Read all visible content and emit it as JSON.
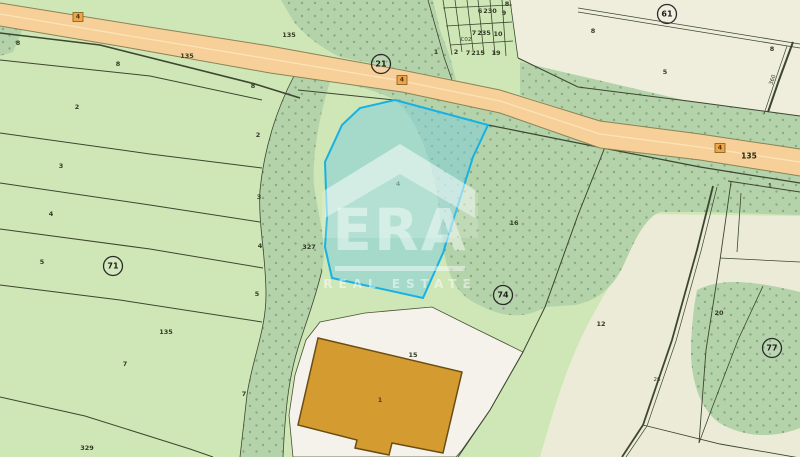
{
  "watermark": {
    "brand": "ERA",
    "subtitle": "REAL ESTATE"
  },
  "colors": {
    "background_green": "#cfe7b6",
    "vegetation_green": "#b4d3aa",
    "vegetation_dot": "#87ab80",
    "cream_parcel": "#efeedd",
    "courtyard_white": "#f4f2ea",
    "road_fill": "#f6cf99",
    "selected_parcel_stroke": "#17b1e3",
    "selected_parcel_fill": "rgba(124,205,222,0.5)",
    "building_fill": "#d49b31",
    "boundary_line": "#3c4630"
  },
  "map": {
    "selected_parcel_label": "4",
    "road_markers": [
      {
        "text": "4",
        "x": 78,
        "y": 17
      },
      {
        "text": "4",
        "x": 402,
        "y": 80
      },
      {
        "text": "4",
        "x": 720,
        "y": 148
      }
    ],
    "circled_labels": [
      {
        "text": "21",
        "x": 381,
        "y": 64
      },
      {
        "text": "61",
        "x": 667,
        "y": 14
      },
      {
        "text": "71",
        "x": 113,
        "y": 266
      },
      {
        "text": "74",
        "x": 503,
        "y": 295
      },
      {
        "text": "77",
        "x": 772,
        "y": 348
      }
    ],
    "labels": [
      {
        "text": "8",
        "x": 18,
        "y": 43
      },
      {
        "text": "135",
        "x": 187,
        "y": 56
      },
      {
        "text": "8",
        "x": 118,
        "y": 64
      },
      {
        "text": "2",
        "x": 77,
        "y": 107
      },
      {
        "text": "8",
        "x": 253,
        "y": 86
      },
      {
        "text": "2",
        "x": 258,
        "y": 135
      },
      {
        "text": "135",
        "x": 289,
        "y": 35
      },
      {
        "text": "3",
        "x": 61,
        "y": 166
      },
      {
        "text": "3",
        "x": 259,
        "y": 197
      },
      {
        "text": "4",
        "x": 51,
        "y": 214
      },
      {
        "text": "4",
        "x": 260,
        "y": 246
      },
      {
        "text": "5",
        "x": 42,
        "y": 262
      },
      {
        "text": "5",
        "x": 257,
        "y": 294
      },
      {
        "text": "135",
        "x": 166,
        "y": 332
      },
      {
        "text": "7",
        "x": 125,
        "y": 364
      },
      {
        "text": "7",
        "x": 244,
        "y": 394
      },
      {
        "text": "329",
        "x": 87,
        "y": 448
      },
      {
        "text": "327",
        "x": 309,
        "y": 247
      },
      {
        "text": "8",
        "x": 507,
        "y": 4
      },
      {
        "text": "6",
        "x": 480,
        "y": 11
      },
      {
        "text": "230",
        "x": 490,
        "y": 11
      },
      {
        "text": "9",
        "x": 504,
        "y": 13
      },
      {
        "text": "7",
        "x": 474,
        "y": 33
      },
      {
        "text": "235",
        "x": 484,
        "y": 33
      },
      {
        "text": "10",
        "x": 498,
        "y": 34
      },
      {
        "text": "C02",
        "x": 466,
        "y": 40,
        "cls": "tiny"
      },
      {
        "text": "1",
        "x": 436,
        "y": 52
      },
      {
        "text": "2",
        "x": 456,
        "y": 52
      },
      {
        "text": "7",
        "x": 468,
        "y": 53
      },
      {
        "text": "215",
        "x": 478,
        "y": 53
      },
      {
        "text": "19",
        "x": 496,
        "y": 53
      },
      {
        "text": "8",
        "x": 593,
        "y": 31
      },
      {
        "text": "5",
        "x": 665,
        "y": 72
      },
      {
        "text": "8",
        "x": 772,
        "y": 49
      },
      {
        "text": "360",
        "x": 773,
        "y": 80,
        "cls": "tiny",
        "rotate": -70
      },
      {
        "text": "135",
        "x": 749,
        "y": 156,
        "cls": "bold"
      },
      {
        "text": "5",
        "x": 770,
        "y": 186,
        "cls": "tiny"
      },
      {
        "text": "16",
        "x": 514,
        "y": 223
      },
      {
        "text": "12",
        "x": 601,
        "y": 324
      },
      {
        "text": "20",
        "x": 719,
        "y": 313
      },
      {
        "text": "26",
        "x": 657,
        "y": 380,
        "cls": "tiny"
      },
      {
        "text": "15",
        "x": 413,
        "y": 355
      },
      {
        "text": "1",
        "x": 380,
        "y": 400,
        "cls": "brown"
      },
      {
        "text": "4",
        "x": 398,
        "y": 184,
        "cls": "faint"
      }
    ]
  }
}
